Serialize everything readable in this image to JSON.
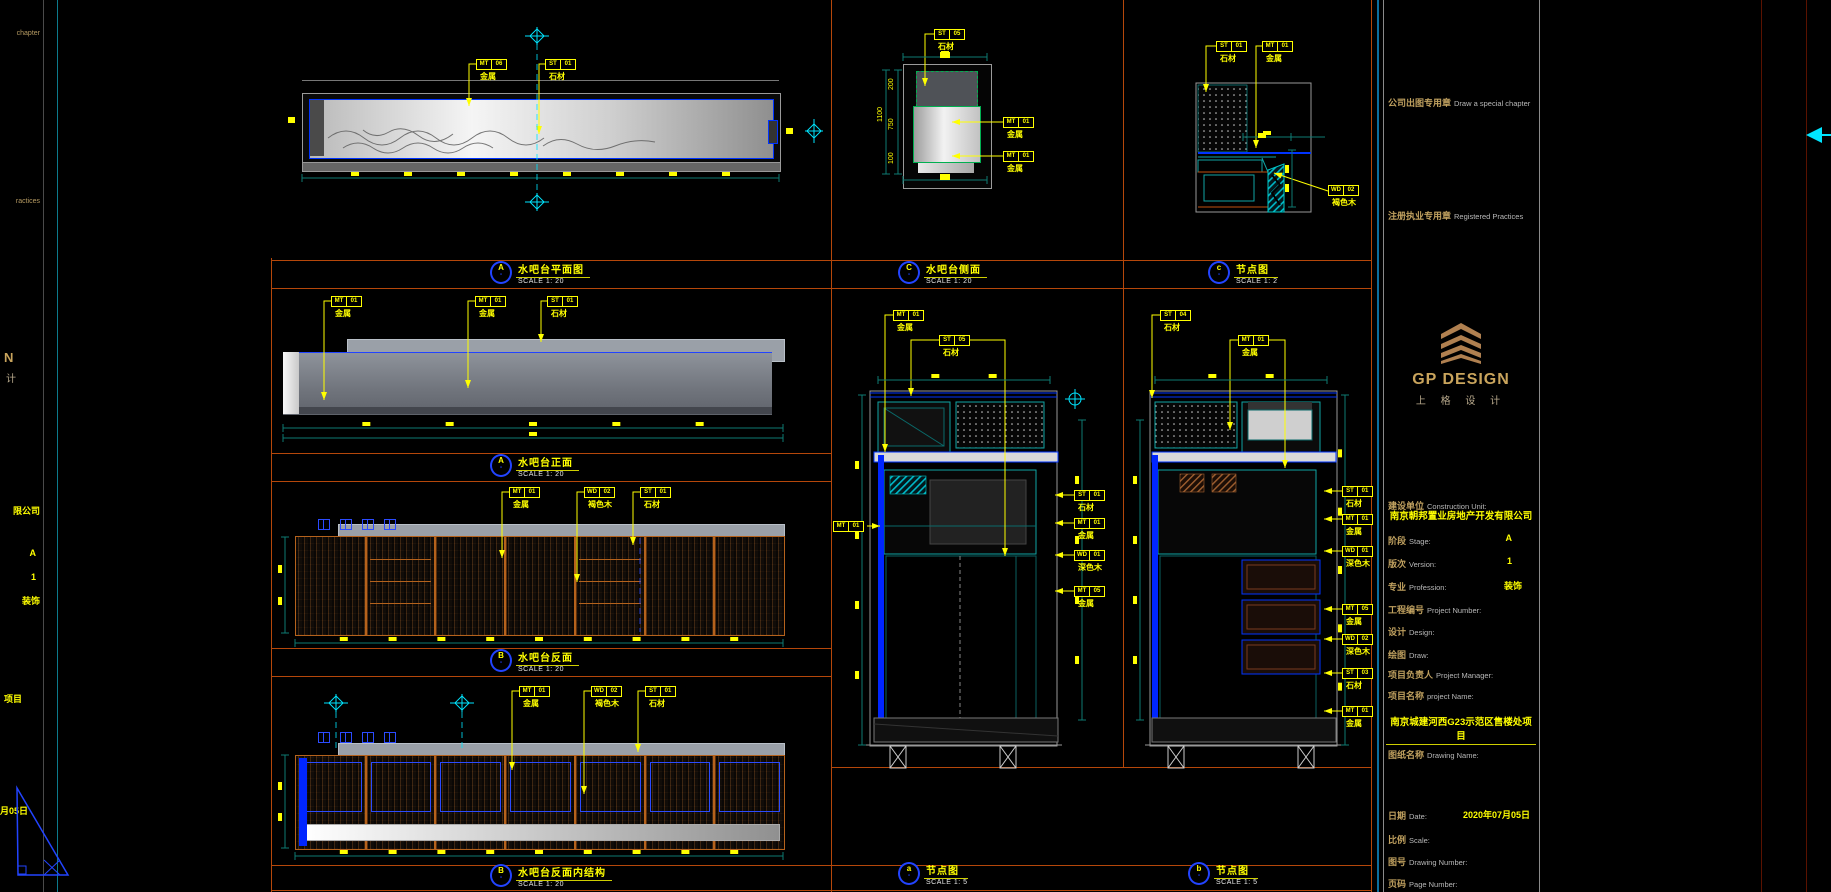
{
  "page": {
    "width": 1831,
    "height": 892
  },
  "colors": {
    "background": "#000000",
    "cad_blue": "#0033ff",
    "cad_cyan": "#00e5ff",
    "dim_teal": "#0e7a72",
    "annotation_yellow": "#ffff00",
    "viewport_orange": "#b5470a",
    "titleblock_blue": "#0c6e9e",
    "gold": "#c9a45c",
    "wood_orange": "#b5621c"
  },
  "left_strip": {
    "chapter_tail": "chapter",
    "practices_tail": "ractices",
    "logo_tail_1": "N",
    "logo_tail_2": "计",
    "company_tail": "限公司",
    "stage_value": "A",
    "version_value": "1",
    "profession_value": "装饰",
    "project_tail": "项目",
    "date_tail": "月05日"
  },
  "view_labels": [
    {
      "letter": "A",
      "sub": "-",
      "title": "水吧台平面图",
      "scale": "SCALE 1: 20",
      "x": 490,
      "y": 261
    },
    {
      "letter": "A",
      "sub": "-",
      "title": "水吧台正面",
      "scale": "SCALE 1: 20",
      "x": 490,
      "y": 454
    },
    {
      "letter": "B",
      "sub": "-",
      "title": "水吧台反面",
      "scale": "SCALE 1: 20",
      "x": 490,
      "y": 649
    },
    {
      "letter": "B",
      "sub": "-",
      "title": "水吧台反面内结构",
      "scale": "SCALE 1: 20",
      "x": 490,
      "y": 864
    },
    {
      "letter": "C",
      "sub": "-",
      "title": "水吧台侧面",
      "scale": "SCALE 1: 20",
      "x": 898,
      "y": 261
    },
    {
      "letter": "c",
      "sub": "-",
      "title": "节点图",
      "scale": "SCALE 1: 2",
      "x": 1208,
      "y": 261
    },
    {
      "letter": "a",
      "sub": "-",
      "title": "节点图",
      "scale": "SCALE 1: 5",
      "x": 898,
      "y": 862
    },
    {
      "letter": "b",
      "sub": "-",
      "title": "节点图",
      "scale": "SCALE 1: 5",
      "x": 1188,
      "y": 862
    }
  ],
  "annotations": {
    "tags": [
      {
        "x": 476,
        "y": 59,
        "c1": "MT",
        "c2": "06",
        "label": "金属",
        "pts": [
          [
            476,
            64
          ],
          [
            469,
            64
          ],
          [
            469,
            106
          ]
        ]
      },
      {
        "x": 545,
        "y": 59,
        "c1": "ST",
        "c2": "01",
        "label": "石材",
        "pts": [
          [
            545,
            64
          ],
          [
            539,
            64
          ],
          [
            539,
            134
          ]
        ]
      },
      {
        "x": 331,
        "y": 296,
        "c1": "MT",
        "c2": "01",
        "label": "金属",
        "pts": [
          [
            331,
            301
          ],
          [
            324,
            301
          ],
          [
            324,
            400
          ]
        ]
      },
      {
        "x": 475,
        "y": 296,
        "c1": "MT",
        "c2": "01",
        "label": "金属",
        "pts": [
          [
            475,
            301
          ],
          [
            468,
            301
          ],
          [
            468,
            388
          ]
        ]
      },
      {
        "x": 547,
        "y": 296,
        "c1": "ST",
        "c2": "01",
        "label": "石材",
        "pts": [
          [
            547,
            301
          ],
          [
            541,
            301
          ],
          [
            541,
            342
          ]
        ]
      },
      {
        "x": 509,
        "y": 487,
        "c1": "MT",
        "c2": "01",
        "label": "金属",
        "pts": [
          [
            509,
            492
          ],
          [
            502,
            492
          ],
          [
            502,
            558
          ]
        ]
      },
      {
        "x": 584,
        "y": 487,
        "c1": "WD",
        "c2": "02",
        "label": "褐色木",
        "pts": [
          [
            584,
            492
          ],
          [
            577,
            492
          ],
          [
            577,
            582
          ]
        ]
      },
      {
        "x": 640,
        "y": 487,
        "c1": "ST",
        "c2": "01",
        "label": "石材",
        "pts": [
          [
            640,
            492
          ],
          [
            633,
            492
          ],
          [
            633,
            545
          ]
        ]
      },
      {
        "x": 519,
        "y": 686,
        "c1": "MT",
        "c2": "01",
        "label": "金属",
        "pts": [
          [
            519,
            691
          ],
          [
            512,
            691
          ],
          [
            512,
            770
          ]
        ]
      },
      {
        "x": 591,
        "y": 686,
        "c1": "WD",
        "c2": "02",
        "label": "褐色木",
        "pts": [
          [
            591,
            691
          ],
          [
            584,
            691
          ],
          [
            584,
            794
          ]
        ]
      },
      {
        "x": 645,
        "y": 686,
        "c1": "ST",
        "c2": "01",
        "label": "石材",
        "pts": [
          [
            645,
            691
          ],
          [
            638,
            691
          ],
          [
            638,
            752
          ]
        ]
      },
      {
        "x": 934,
        "y": 29,
        "c1": "ST",
        "c2": "05",
        "label": "石材",
        "pts": [
          [
            934,
            34
          ],
          [
            925,
            34
          ],
          [
            925,
            86
          ]
        ]
      },
      {
        "x": 1003,
        "y": 117,
        "c1": "MT",
        "c2": "01",
        "label": "金属",
        "pts": [
          [
            1003,
            122
          ],
          [
            952,
            122
          ]
        ]
      },
      {
        "x": 1003,
        "y": 151,
        "c1": "MT",
        "c2": "01",
        "label": "金属",
        "pts": [
          [
            1003,
            156
          ],
          [
            952,
            156
          ]
        ]
      },
      {
        "x": 1216,
        "y": 41,
        "c1": "ST",
        "c2": "01",
        "label": "石材",
        "pts": [
          [
            1216,
            46
          ],
          [
            1206,
            46
          ],
          [
            1206,
            92
          ]
        ]
      },
      {
        "x": 1262,
        "y": 41,
        "c1": "MT",
        "c2": "01",
        "label": "金属",
        "pts": [
          [
            1262,
            46
          ],
          [
            1256,
            46
          ],
          [
            1256,
            148
          ]
        ]
      },
      {
        "x": 1328,
        "y": 185,
        "c1": "WD",
        "c2": "02",
        "label": "褐色木",
        "pts": [
          [
            1328,
            191
          ],
          [
            1274,
            173
          ]
        ]
      },
      {
        "x": 893,
        "y": 310,
        "c1": "MT",
        "c2": "01",
        "label": "金属",
        "pts": [
          [
            893,
            315
          ],
          [
            885,
            315
          ],
          [
            885,
            452
          ]
        ]
      },
      {
        "x": 939,
        "y": 335,
        "c1": "ST",
        "c2": "05",
        "label": "石材",
        "pts": [
          [
            939,
            340
          ],
          [
            911,
            340
          ],
          [
            911,
            396
          ]
        ]
      },
      {
        "x": 833,
        "y": 521,
        "c1": "MT",
        "c2": "01",
        "label": "",
        "pts": [
          [
            867,
            526
          ],
          [
            880,
            526
          ]
        ]
      },
      {
        "x": 1074,
        "y": 490,
        "c1": "ST",
        "c2": "01",
        "label": "石材",
        "pts": [
          [
            1074,
            495
          ],
          [
            1055,
            495
          ]
        ]
      },
      {
        "x": 1074,
        "y": 518,
        "c1": "MT",
        "c2": "01",
        "label": "金属",
        "pts": [
          [
            1074,
            523
          ],
          [
            1055,
            523
          ]
        ]
      },
      {
        "x": 1074,
        "y": 550,
        "c1": "WD",
        "c2": "01",
        "label": "深色木",
        "pts": [
          [
            1074,
            555
          ],
          [
            1055,
            555
          ]
        ]
      },
      {
        "x": 1074,
        "y": 586,
        "c1": "MT",
        "c2": "05",
        "label": "金属",
        "pts": [
          [
            1074,
            591
          ],
          [
            1055,
            591
          ]
        ]
      },
      {
        "x": 1160,
        "y": 310,
        "c1": "ST",
        "c2": "04",
        "label": "石材",
        "pts": [
          [
            1160,
            315
          ],
          [
            1152,
            315
          ],
          [
            1152,
            398
          ]
        ]
      },
      {
        "x": 1238,
        "y": 335,
        "c1": "MT",
        "c2": "01",
        "label": "金属",
        "pts": [
          [
            1238,
            340
          ],
          [
            1230,
            340
          ],
          [
            1230,
            430
          ]
        ]
      },
      {
        "x": 1342,
        "y": 486,
        "c1": "ST",
        "c2": "01",
        "label": "石材",
        "pts": [
          [
            1342,
            491
          ],
          [
            1324,
            491
          ]
        ]
      },
      {
        "x": 1342,
        "y": 514,
        "c1": "MT",
        "c2": "01",
        "label": "金属",
        "pts": [
          [
            1342,
            519
          ],
          [
            1324,
            519
          ]
        ]
      },
      {
        "x": 1342,
        "y": 546,
        "c1": "WD",
        "c2": "01",
        "label": "深色木",
        "pts": [
          [
            1342,
            551
          ],
          [
            1324,
            551
          ]
        ]
      },
      {
        "x": 1342,
        "y": 604,
        "c1": "MT",
        "c2": "05",
        "label": "金属",
        "pts": [
          [
            1342,
            609
          ],
          [
            1324,
            609
          ]
        ]
      },
      {
        "x": 1342,
        "y": 634,
        "c1": "WD",
        "c2": "02",
        "label": "深色木",
        "pts": [
          [
            1342,
            639
          ],
          [
            1324,
            639
          ]
        ]
      },
      {
        "x": 1342,
        "y": 668,
        "c1": "ST",
        "c2": "03",
        "label": "石材",
        "pts": [
          [
            1342,
            673
          ],
          [
            1324,
            673
          ]
        ]
      },
      {
        "x": 1342,
        "y": 706,
        "c1": "MT",
        "c2": "01",
        "label": "金属",
        "pts": [
          [
            1342,
            711
          ],
          [
            1324,
            711
          ]
        ]
      }
    ],
    "dim_texts": [
      {
        "t": "200",
        "x": 888,
        "y": 90
      },
      {
        "t": "750",
        "x": 888,
        "y": 130
      },
      {
        "t": "100",
        "x": 888,
        "y": 164
      },
      {
        "t": "1100",
        "x": 877,
        "y": 122
      }
    ]
  },
  "title_block": {
    "company_chapter_cn": "公司出图专用章",
    "company_chapter_en": "Draw a special chapter",
    "registered_cn": "注册执业专用章",
    "registered_en": "Registered Practices",
    "logo": {
      "name": "GP DESIGN",
      "cn": "上 格 设 计"
    },
    "construction_label_cn": "建设单位",
    "construction_label_en": "Construction Unit:",
    "construction_company": "南京朝邦置业房地产开发有限公司",
    "rows": [
      {
        "cn": "阶段",
        "en": "Stage:",
        "value": "A"
      },
      {
        "cn": "版次",
        "en": "Version:",
        "value": "1"
      },
      {
        "cn": "专业",
        "en": "Profession:",
        "value": "装饰"
      },
      {
        "cn": "工程编号",
        "en": "Project Number:",
        "value": ""
      },
      {
        "cn": "设计",
        "en": "Design:",
        "value": ""
      },
      {
        "cn": "绘图",
        "en": "Draw:",
        "value": ""
      },
      {
        "cn": "项目负责人",
        "en": "Project Manager:",
        "value": ""
      }
    ],
    "project_label_cn": "项目名称",
    "project_label_en": "project Name:",
    "project_name": "南京城建河西G23示范区售楼处项目",
    "drawing_label_cn": "图纸名称",
    "drawing_label_en": "Drawing Name:",
    "bottom_rows": [
      {
        "cn": "日期",
        "en": "Date:",
        "value": "2020年07月05日"
      },
      {
        "cn": "比例",
        "en": "Scale:",
        "value": ""
      },
      {
        "cn": "图号",
        "en": "Drawing Number:",
        "value": ""
      },
      {
        "cn": "页码",
        "en": "Page Number:",
        "value": ""
      }
    ]
  }
}
